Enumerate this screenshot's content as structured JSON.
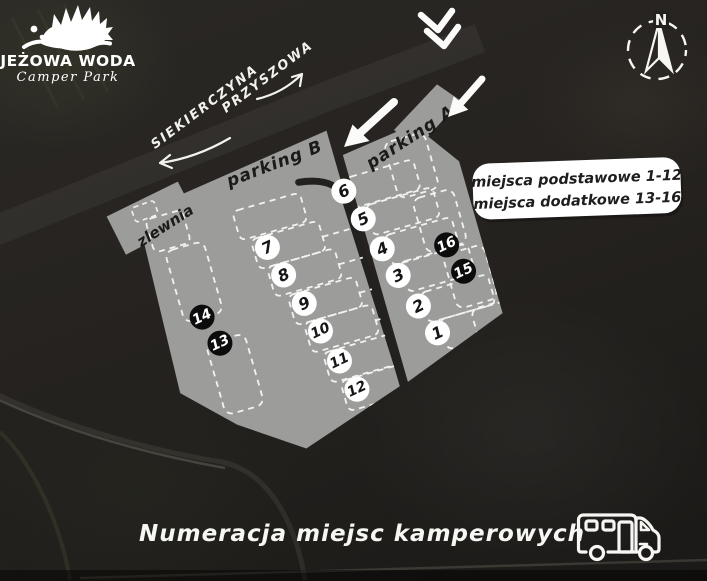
{
  "logo": {
    "title": "JEŻOWA WODA",
    "subtitle": "Camper Park"
  },
  "compass": {
    "north_label": "N"
  },
  "streets": {
    "left": "SIEKIERCZYNA",
    "right": "PRZYSZOWA"
  },
  "map": {
    "parking_b_label": "parking B",
    "parking_a_label": "parking A",
    "zlewnia_label": "zlewnia",
    "spots": [
      {
        "number": "1",
        "type": "basic"
      },
      {
        "number": "2",
        "type": "basic"
      },
      {
        "number": "3",
        "type": "basic"
      },
      {
        "number": "4",
        "type": "basic"
      },
      {
        "number": "5",
        "type": "basic"
      },
      {
        "number": "6",
        "type": "basic"
      },
      {
        "number": "7",
        "type": "basic"
      },
      {
        "number": "8",
        "type": "basic"
      },
      {
        "number": "9",
        "type": "basic"
      },
      {
        "number": "10",
        "type": "basic"
      },
      {
        "number": "11",
        "type": "basic"
      },
      {
        "number": "12",
        "type": "basic"
      },
      {
        "number": "13",
        "type": "additional"
      },
      {
        "number": "14",
        "type": "additional"
      },
      {
        "number": "15",
        "type": "additional"
      },
      {
        "number": "16",
        "type": "additional"
      }
    ]
  },
  "legend": {
    "line1": "miejsca podstawowe 1-12",
    "line2": "miejsca dodatkowe 13-16"
  },
  "footer": {
    "title": "Numeracja miejsc kamperowych"
  },
  "colors": {
    "lot_fill": "#9c9c9a",
    "spot_basic_fill": "#ffffff",
    "spot_basic_text": "#161616",
    "spot_additional_fill": "#0c0c0c",
    "spot_additional_text": "#ffffff",
    "map_ink": "#1d1c1a",
    "white": "#f6f6f3"
  }
}
